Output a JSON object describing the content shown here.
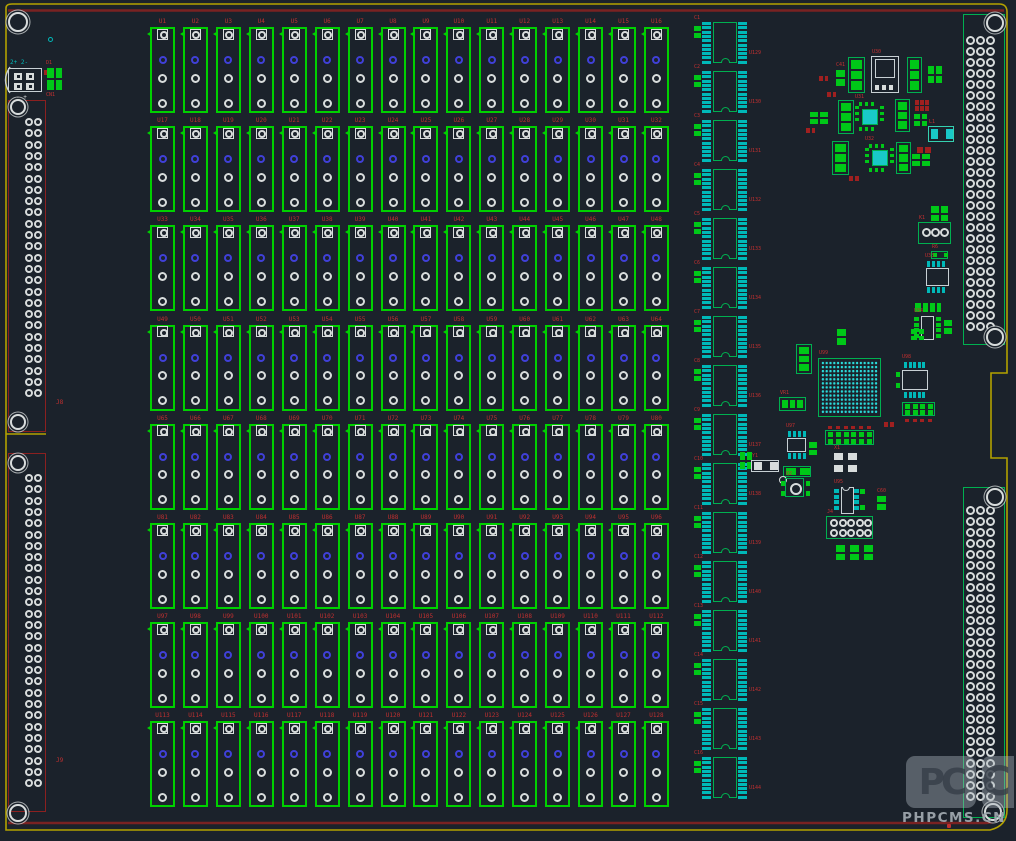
{
  "app": {
    "type": "pcb-layout-editor-canvas"
  },
  "colors": {
    "bg": "#1b222b",
    "board_edge": "#b3a100",
    "inner_border": "#7a2222",
    "relay_outline": "#00d000",
    "pad_white": "#d8dcdc",
    "pad_blue": "#4040d8",
    "pad_teal": "#00b8b8",
    "cyan_bright": "#2adada",
    "green_fill": "#00c818",
    "conn_green": "#00b050",
    "conn_red": "#8b2020",
    "label_red": "#c03030",
    "part_red": "#a02020",
    "white_outline": "#c8d0d4",
    "watermark_gray": "#9aa2a8"
  },
  "relay_grid": {
    "rows": 8,
    "cols": 16,
    "origin_x": 150,
    "origin_y": 27,
    "pitch_x": 32.93,
    "pitch_y": 99.2,
    "cell_w": 25,
    "cell_h": 86,
    "pad_offsets": [
      7,
      33,
      51,
      76
    ],
    "labels": [
      "U1",
      "U2",
      "U3",
      "U4",
      "U5",
      "U6",
      "U7",
      "U8",
      "U9",
      "U10",
      "U11",
      "U12",
      "U13",
      "U14",
      "U15",
      "U16",
      "U17",
      "U18",
      "U19",
      "U20",
      "U21",
      "U22",
      "U23",
      "U24",
      "U25",
      "U26",
      "U27",
      "U28",
      "U29",
      "U30",
      "U31",
      "U32",
      "U33",
      "U34",
      "U35",
      "U36",
      "U37",
      "U38",
      "U39",
      "U40",
      "U41",
      "U42",
      "U43",
      "U44",
      "U45",
      "U46",
      "U47",
      "U48",
      "U49",
      "U50",
      "U51",
      "U52",
      "U53",
      "U54",
      "U55",
      "U56",
      "U57",
      "U58",
      "U59",
      "U60",
      "U61",
      "U62",
      "U63",
      "U64",
      "U65",
      "U66",
      "U67",
      "U68",
      "U69",
      "U70",
      "U71",
      "U72",
      "U73",
      "U74",
      "U75",
      "U76",
      "U77",
      "U78",
      "U79",
      "U80",
      "U81",
      "U82",
      "U83",
      "U84",
      "U85",
      "U86",
      "U87",
      "U88",
      "U89",
      "U90",
      "U91",
      "U92",
      "U93",
      "U94",
      "U95",
      "U96",
      "U97",
      "U98",
      "U99",
      "U100",
      "U101",
      "U102",
      "U103",
      "U104",
      "U105",
      "U106",
      "U107",
      "U108",
      "U109",
      "U110",
      "U111",
      "U112",
      "U113",
      "U114",
      "U115",
      "U116",
      "U117",
      "U118",
      "U119",
      "U120",
      "U121",
      "U122",
      "U123",
      "U124",
      "U125",
      "U126",
      "U127",
      "U128"
    ]
  },
  "ic_column": {
    "x": 694,
    "y": 22,
    "pitch": 49,
    "count": 16,
    "labels": [
      "U129",
      "U130",
      "U131",
      "U132",
      "U133",
      "U134",
      "U135",
      "U136",
      "U137",
      "U138",
      "U139",
      "U140",
      "U141",
      "U142",
      "U143",
      "U144"
    ],
    "cap_labels": [
      "C1",
      "C2",
      "C3",
      "C4",
      "C5",
      "C6",
      "C7",
      "C8",
      "C9",
      "C10",
      "C11",
      "C12",
      "C13",
      "C14",
      "C15",
      "C16"
    ]
  },
  "connectors": {
    "left": [
      {
        "label": "J8",
        "x": 8,
        "y": 100,
        "w": 38,
        "h": 332,
        "pad_start_y": 122,
        "pad_rows": 25,
        "pad_pitch": 11.3,
        "pad_cols_x": [
          29,
          38
        ]
      },
      {
        "label": "J9",
        "x": 8,
        "y": 453,
        "w": 38,
        "h": 359,
        "pad_start_y": 478,
        "pad_rows": 28,
        "pad_pitch": 11.3,
        "pad_cols_x": [
          29,
          38
        ]
      }
    ],
    "right": [
      {
        "label": "J2",
        "x": 963,
        "y": 14,
        "w": 42,
        "h": 331,
        "pad_start_y": 40,
        "pad_rows": 27,
        "pad_pitch": 11,
        "pad_cols_x": [
          970,
          980,
          990
        ]
      },
      {
        "label": "J3",
        "x": 963,
        "y": 487,
        "w": 42,
        "h": 331,
        "pad_start_y": 510,
        "pad_rows": 27,
        "pad_pitch": 11,
        "pad_cols_x": [
          970,
          980,
          990
        ]
      }
    ]
  },
  "corner_block": {
    "label_top": "2+ 2-",
    "label_bottom": "- +",
    "j1": {
      "x": 8,
      "y": 68,
      "w": 34,
      "h": 24
    },
    "cn": {
      "x": 47,
      "y": 68,
      "w": 15,
      "h": 22,
      "label_above": "D1",
      "label_below": "CN1"
    }
  },
  "mount_holes": [
    {
      "x": 18,
      "y": 22,
      "r": 10
    },
    {
      "x": 18,
      "y": 107,
      "r": 8
    },
    {
      "x": 18,
      "y": 422,
      "r": 8
    },
    {
      "x": 18,
      "y": 463,
      "r": 8
    },
    {
      "x": 18,
      "y": 813,
      "r": 9
    },
    {
      "x": 995,
      "y": 23,
      "r": 9
    },
    {
      "x": 995,
      "y": 337,
      "r": 9
    },
    {
      "x": 995,
      "y": 497,
      "r": 9
    },
    {
      "x": 993,
      "y": 812,
      "r": 9
    }
  ],
  "fiducial": {
    "x": 50,
    "y": 39
  },
  "free_labels": [
    {
      "text": "J8",
      "x": 56,
      "y": 399
    },
    {
      "text": "J9",
      "x": 56,
      "y": 757
    }
  ],
  "bga": {
    "x": 818,
    "y": 358,
    "w": 63,
    "h": 59,
    "rows": 13,
    "cols": 15,
    "label": "U99"
  },
  "misc_components": [
    {
      "t": "pads2v",
      "x": 836,
      "y": 70,
      "w": 9,
      "h": 16,
      "lbl": "C41"
    },
    {
      "t": "sot3v",
      "x": 848,
      "y": 57,
      "w": 17,
      "h": 36
    },
    {
      "t": "dpak",
      "x": 871,
      "y": 56,
      "w": 28,
      "h": 37,
      "lbl": "U30"
    },
    {
      "t": "sot3v",
      "x": 907,
      "y": 57,
      "w": 15,
      "h": 36
    },
    {
      "t": "pads2x2",
      "x": 928,
      "y": 66,
      "w": 14,
      "h": 17
    },
    {
      "t": "red2h",
      "x": 819,
      "y": 76,
      "w": 9,
      "h": 5
    },
    {
      "t": "red2h",
      "x": 827,
      "y": 92,
      "w": 9,
      "h": 5
    },
    {
      "t": "sot3v",
      "x": 838,
      "y": 100,
      "w": 16,
      "h": 34
    },
    {
      "t": "qfn",
      "x": 855,
      "y": 102,
      "w": 29,
      "h": 29,
      "lbl": "U31"
    },
    {
      "t": "sot3v",
      "x": 895,
      "y": 99,
      "w": 15,
      "h": 33
    },
    {
      "t": "red3x2",
      "x": 915,
      "y": 100,
      "w": 15,
      "h": 12
    },
    {
      "t": "pads2x2",
      "x": 914,
      "y": 114,
      "w": 13,
      "h": 12
    },
    {
      "t": "pads2x2",
      "x": 810,
      "y": 112,
      "w": 18,
      "h": 12
    },
    {
      "t": "red2h",
      "x": 806,
      "y": 128,
      "w": 9,
      "h": 5
    },
    {
      "t": "sot3v",
      "x": 832,
      "y": 141,
      "w": 17,
      "h": 34
    },
    {
      "t": "qfn",
      "x": 865,
      "y": 144,
      "w": 29,
      "h": 28,
      "lbl": "U32"
    },
    {
      "t": "sot3v",
      "x": 896,
      "y": 142,
      "w": 15,
      "h": 32
    },
    {
      "t": "chip2",
      "x": 928,
      "y": 126,
      "w": 26,
      "h": 16,
      "lbl": "L1"
    },
    {
      "t": "red2h",
      "x": 917,
      "y": 147,
      "w": 14,
      "h": 6
    },
    {
      "t": "pads2x2",
      "x": 912,
      "y": 154,
      "w": 18,
      "h": 12
    },
    {
      "t": "red2h",
      "x": 849,
      "y": 176,
      "w": 10,
      "h": 5
    },
    {
      "t": "pads2x2",
      "x": 931,
      "y": 206,
      "w": 17,
      "h": 15
    },
    {
      "t": "conn3c",
      "x": 918,
      "y": 222,
      "w": 33,
      "h": 22,
      "lbl": "K1"
    },
    {
      "t": "resg",
      "x": 931,
      "y": 251,
      "w": 17,
      "h": 8,
      "lbl": "R6"
    },
    {
      "t": "soic8h",
      "x": 925,
      "y": 261,
      "w": 25,
      "h": 32,
      "lbl": "U33"
    },
    {
      "t": "pads2h",
      "x": 915,
      "y": 303,
      "w": 13,
      "h": 9
    },
    {
      "t": "pads2h",
      "x": 930,
      "y": 303,
      "w": 11,
      "h": 9
    },
    {
      "t": "soic8g",
      "x": 914,
      "y": 316,
      "w": 27,
      "h": 24,
      "lbl": "U34"
    },
    {
      "t": "pads2v",
      "x": 944,
      "y": 320,
      "w": 8,
      "h": 14
    },
    {
      "t": "sot3v",
      "x": 796,
      "y": 344,
      "w": 16,
      "h": 30
    },
    {
      "t": "pads2v",
      "x": 837,
      "y": 329,
      "w": 9,
      "h": 16
    },
    {
      "t": "pads2x2",
      "x": 911,
      "y": 329,
      "w": 13,
      "h": 11
    },
    {
      "t": "sot3h",
      "x": 779,
      "y": 397,
      "w": 27,
      "h": 14,
      "lbl": "VR1"
    },
    {
      "t": "qfp",
      "x": 902,
      "y": 362,
      "w": 26,
      "h": 36,
      "lbl": "U98"
    },
    {
      "t": "hdr2x4",
      "x": 902,
      "y": 402,
      "w": 33,
      "h": 14
    },
    {
      "t": "red2h",
      "x": 884,
      "y": 422,
      "w": 10,
      "h": 5
    },
    {
      "t": "pads2x2",
      "x": 740,
      "y": 452,
      "w": 12,
      "h": 17
    },
    {
      "t": "soic8h",
      "x": 786,
      "y": 431,
      "w": 21,
      "h": 28,
      "lbl": "U97"
    },
    {
      "t": "pads2v",
      "x": 809,
      "y": 442,
      "w": 8,
      "h": 13
    },
    {
      "t": "hdr2x6",
      "x": 825,
      "y": 430,
      "w": 49,
      "h": 15
    },
    {
      "t": "xtal2",
      "x": 751,
      "y": 460,
      "w": 28,
      "h": 12,
      "lbl": "Y1"
    },
    {
      "t": "grect2",
      "x": 783,
      "y": 466,
      "w": 28,
      "h": 11
    },
    {
      "t": "circ4",
      "x": 785,
      "y": 478,
      "w": 19,
      "h": 19,
      "lbl": "Q2"
    },
    {
      "t": "osc4",
      "x": 834,
      "y": 453,
      "w": 24,
      "h": 20,
      "lbl": "X1"
    },
    {
      "t": "soic8gv",
      "x": 834,
      "y": 487,
      "w": 31,
      "h": 27,
      "lbl": "U95"
    },
    {
      "t": "pads2v",
      "x": 877,
      "y": 496,
      "w": 9,
      "h": 14,
      "lbl": "C60"
    },
    {
      "t": "hdr2x5",
      "x": 826,
      "y": 516,
      "w": 47,
      "h": 23,
      "lbl": "J4"
    },
    {
      "t": "pads2v",
      "x": 836,
      "y": 545,
      "w": 9,
      "h": 15
    },
    {
      "t": "pads2v",
      "x": 850,
      "y": 545,
      "w": 9,
      "h": 15
    },
    {
      "t": "pads2v",
      "x": 864,
      "y": 545,
      "w": 9,
      "h": 15
    }
  ],
  "watermark": {
    "logo": "PC",
    "logo2": "C",
    "text": "PHPCMS.CN"
  }
}
